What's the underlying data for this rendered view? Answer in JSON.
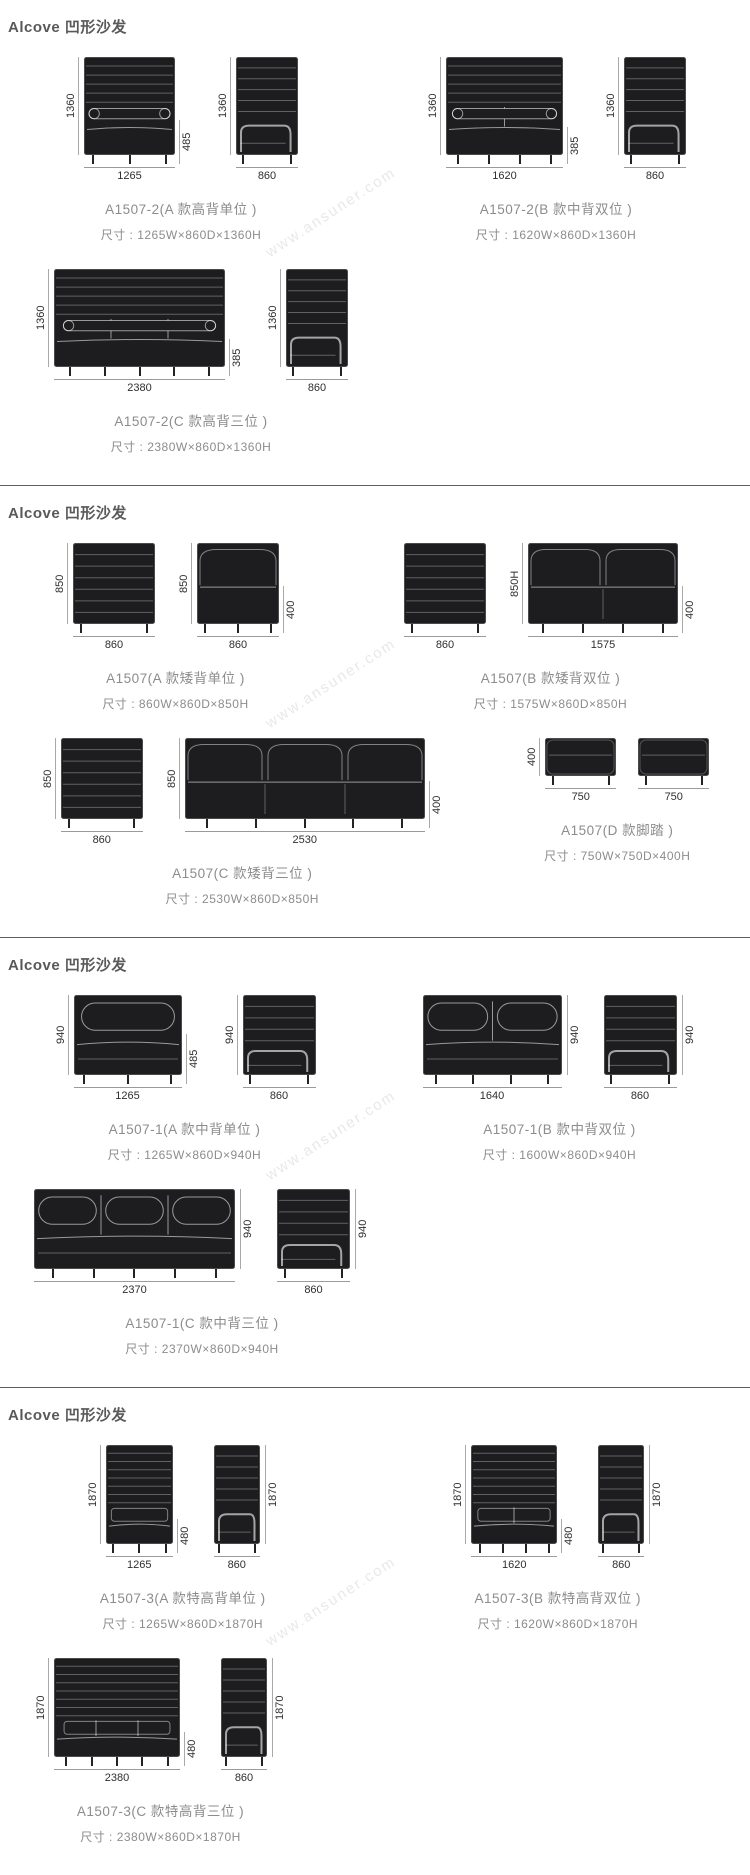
{
  "watermark": "www.ansuner.com",
  "sections": [
    {
      "header": "Alcove 凹形沙发",
      "rows": [
        {
          "products": [
            {
              "model": "A1507-2(A 款高背单位 )",
              "size": "尺寸 : 1265W×860D×1360H",
              "views": [
                {
                  "kind": "front",
                  "style": "high",
                  "mm_w": 1265,
                  "mm_h": 1360,
                  "seats": 1,
                  "h_label": "1360",
                  "w_label": "1265",
                  "seat_label": "485",
                  "seat_mm": 485
                },
                {
                  "kind": "side",
                  "style": "high",
                  "mm_w": 860,
                  "mm_h": 1360,
                  "h_label": "1360",
                  "w_label": "860"
                }
              ]
            },
            {
              "model": "A1507-2(B 款中背双位 )",
              "size": "尺寸 : 1620W×860D×1360H",
              "views": [
                {
                  "kind": "front",
                  "style": "high",
                  "mm_w": 1620,
                  "mm_h": 1360,
                  "seats": 2,
                  "h_label": "1360",
                  "w_label": "1620",
                  "seat_label": "385",
                  "seat_mm": 385
                },
                {
                  "kind": "side",
                  "style": "high",
                  "mm_w": 860,
                  "mm_h": 1360,
                  "h_label": "1360",
                  "w_label": "860"
                }
              ]
            }
          ]
        },
        {
          "products": [
            {
              "model": "A1507-2(C 款高背三位 )",
              "size": "尺寸 : 2380W×860D×1360H",
              "views": [
                {
                  "kind": "front",
                  "style": "high",
                  "mm_w": 2380,
                  "mm_h": 1360,
                  "seats": 3,
                  "h_label": "1360",
                  "w_label": "2380",
                  "seat_label": "385",
                  "seat_mm": 385
                },
                {
                  "kind": "side",
                  "style": "high",
                  "mm_w": 860,
                  "mm_h": 1360,
                  "h_label": "1360",
                  "w_label": "860"
                }
              ]
            }
          ]
        }
      ]
    },
    {
      "header": "Alcove 凹形沙发",
      "rows": [
        {
          "products": [
            {
              "model": "A1507(A 款矮背单位 )",
              "size": "尺寸 : 860W×860D×850H",
              "views": [
                {
                  "kind": "side",
                  "style": "low",
                  "mm_w": 860,
                  "mm_h": 850,
                  "h_label": "850",
                  "w_label": "860"
                },
                {
                  "kind": "front",
                  "style": "low",
                  "mm_w": 860,
                  "mm_h": 850,
                  "seats": 1,
                  "h_label": "850",
                  "w_label": "860",
                  "seat_label": "400",
                  "seat_mm": 400
                }
              ]
            },
            {
              "model": "A1507(B 款矮背双位 )",
              "size": "尺寸 : 1575W×860D×850H",
              "views": [
                {
                  "kind": "side",
                  "style": "low",
                  "mm_w": 860,
                  "mm_h": 850,
                  "w_label": "860"
                },
                {
                  "kind": "front",
                  "style": "low",
                  "mm_w": 1575,
                  "mm_h": 850,
                  "seats": 2,
                  "h_label": "850H",
                  "w_label": "1575",
                  "seat_label": "400",
                  "seat_mm": 400
                }
              ]
            }
          ]
        },
        {
          "products": [
            {
              "model": "A1507(C 款矮背三位 )",
              "size": "尺寸 : 2530W×860D×850H",
              "views": [
                {
                  "kind": "side",
                  "style": "low",
                  "mm_w": 860,
                  "mm_h": 850,
                  "h_label": "850",
                  "w_label": "860"
                },
                {
                  "kind": "front",
                  "style": "low",
                  "mm_w": 2530,
                  "mm_h": 850,
                  "seats": 3,
                  "h_label": "850",
                  "w_label": "2530",
                  "seat_label": "400",
                  "seat_mm": 400
                }
              ]
            },
            {
              "model": "A1507(D 款脚踏 )",
              "size": "尺寸 : 750W×750D×400H",
              "views": [
                {
                  "kind": "stool",
                  "style": "low",
                  "mm_w": 750,
                  "mm_h": 400,
                  "h_label": "400",
                  "w_label": "750"
                },
                {
                  "kind": "stool",
                  "style": "low",
                  "mm_w": 750,
                  "mm_h": 400,
                  "w_label": "750"
                }
              ]
            }
          ]
        }
      ]
    },
    {
      "header": "Alcove 凹形沙发",
      "rows": [
        {
          "products": [
            {
              "model": "A1507-1(A 款中背单位 )",
              "size": "尺寸 : 1265W×860D×940H",
              "views": [
                {
                  "kind": "front",
                  "style": "mid",
                  "mm_w": 1265,
                  "mm_h": 940,
                  "seats": 1,
                  "h_label": "940",
                  "w_label": "1265",
                  "seat_label": "485",
                  "seat_mm": 485
                },
                {
                  "kind": "side",
                  "style": "mid",
                  "mm_w": 860,
                  "mm_h": 940,
                  "h_label": "940",
                  "w_label": "860"
                }
              ]
            },
            {
              "model": "A1507-1(B 款中背双位 )",
              "size": "尺寸 : 1600W×860D×940H",
              "views": [
                {
                  "kind": "front",
                  "style": "mid",
                  "mm_w": 1640,
                  "mm_h": 940,
                  "seats": 2,
                  "h_label_right": "940",
                  "w_label": "1640"
                },
                {
                  "kind": "side",
                  "style": "mid",
                  "mm_w": 860,
                  "mm_h": 940,
                  "h_label_right": "940",
                  "w_label": "860"
                }
              ]
            }
          ]
        },
        {
          "products": [
            {
              "model": "A1507-1(C 款中背三位 )",
              "size": "尺寸 : 2370W×860D×940H",
              "views": [
                {
                  "kind": "front",
                  "style": "mid",
                  "mm_w": 2370,
                  "mm_h": 940,
                  "seats": 3,
                  "h_label_right": "940",
                  "w_label": "2370"
                },
                {
                  "kind": "side",
                  "style": "mid",
                  "mm_w": 860,
                  "mm_h": 940,
                  "h_label_right": "940",
                  "w_label": "860"
                }
              ]
            }
          ]
        }
      ]
    },
    {
      "header": "Alcove 凹形沙发",
      "rows": [
        {
          "products": [
            {
              "model": "A1507-3(A 款特高背单位 )",
              "size": "尺寸 : 1265W×860D×1870H",
              "views": [
                {
                  "kind": "front",
                  "style": "xhigh",
                  "mm_w": 1265,
                  "mm_h": 1870,
                  "seats": 1,
                  "h_label": "1870",
                  "w_label": "1265",
                  "seat_label": "480",
                  "seat_mm": 480
                },
                {
                  "kind": "side",
                  "style": "xhigh",
                  "mm_w": 860,
                  "mm_h": 1870,
                  "h_label_right": "1870",
                  "w_label": "860"
                }
              ]
            },
            {
              "model": "A1507-3(B 款特高背双位 )",
              "size": "尺寸 : 1620W×860D×1870H",
              "views": [
                {
                  "kind": "front",
                  "style": "xhigh",
                  "mm_w": 1620,
                  "mm_h": 1870,
                  "seats": 2,
                  "h_label": "1870",
                  "w_label": "1620",
                  "seat_label": "480",
                  "seat_mm": 480
                },
                {
                  "kind": "side",
                  "style": "xhigh",
                  "mm_w": 860,
                  "mm_h": 1870,
                  "h_label_right": "1870",
                  "w_label": "860"
                }
              ]
            }
          ]
        },
        {
          "products": [
            {
              "model": "A1507-3(C 款特高背三位 )",
              "size": "尺寸 : 2380W×860D×1870H",
              "views": [
                {
                  "kind": "front",
                  "style": "xhigh",
                  "mm_w": 2380,
                  "mm_h": 1870,
                  "seats": 3,
                  "h_label": "1870",
                  "w_label": "2380",
                  "seat_label": "480",
                  "seat_mm": 480
                },
                {
                  "kind": "side",
                  "style": "xhigh",
                  "mm_w": 860,
                  "mm_h": 1870,
                  "h_label_right": "1870",
                  "w_label": "860"
                }
              ]
            }
          ]
        }
      ]
    }
  ]
}
